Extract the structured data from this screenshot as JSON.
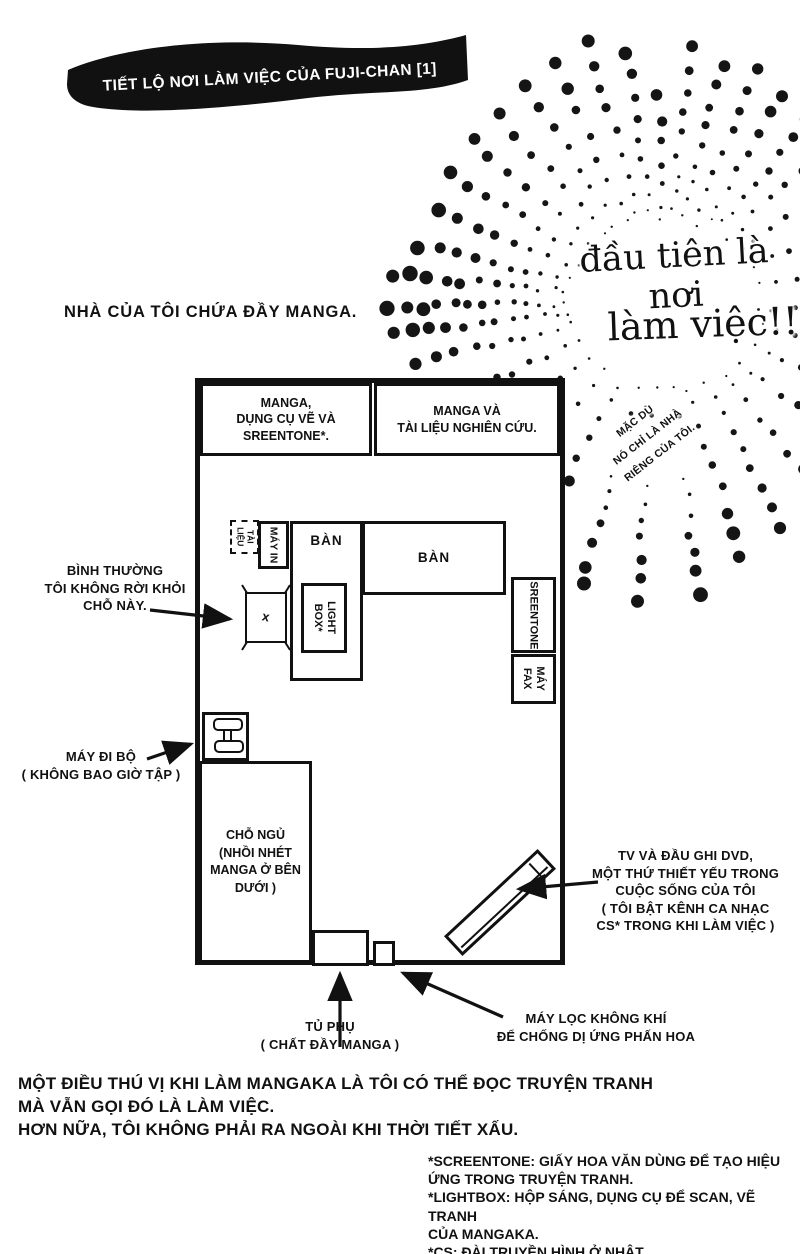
{
  "ink": "#111111",
  "paper": "#ffffff",
  "banner": {
    "title": "TIẾT LỘ NƠI LÀM VIỆC CỦA FUJI-CHAN [1]"
  },
  "intro": "NHÀ CỦA TÔI CHỨA ĐẦY MANGA.",
  "burst": {
    "line1": "đầu tiên là nơi",
    "line2": "làm việc!!",
    "aside": "MẶC DÙ\nNÓ CHỈ LÀ NHÀ\nRIÊNG CỦA TÔI.",
    "cx": 663,
    "cy": 302,
    "rays": [
      [
        -106,
        95,
        272,
        9,
        6.5
      ],
      [
        -98,
        90,
        250,
        9,
        6
      ],
      [
        -91,
        80,
        205,
        7,
        5.5
      ],
      [
        -84,
        95,
        255,
        9,
        5.5
      ],
      [
        -76,
        90,
        245,
        9,
        6
      ],
      [
        -68,
        85,
        250,
        9,
        6
      ],
      [
        -60,
        95,
        240,
        8,
        6
      ],
      [
        -52,
        100,
        230,
        8,
        5.5
      ],
      [
        -44,
        90,
        215,
        7,
        5
      ],
      [
        -34,
        95,
        195,
        6,
        5
      ],
      [
        -22,
        100,
        175,
        5,
        4.5
      ],
      [
        -10,
        100,
        155,
        4,
        4
      ],
      [
        3,
        95,
        150,
        4,
        3
      ],
      [
        14,
        100,
        175,
        5,
        4.5
      ],
      [
        26,
        100,
        195,
        6,
        5
      ],
      [
        38,
        95,
        215,
        7,
        5.5
      ],
      [
        50,
        95,
        240,
        8,
        6
      ],
      [
        62,
        90,
        255,
        9,
        6.5
      ],
      [
        73,
        90,
        268,
        9,
        7
      ],
      [
        83,
        180,
        295,
        7,
        7
      ],
      [
        83,
        85,
        115,
        2,
        2.5
      ],
      [
        95,
        185,
        300,
        7,
        7
      ],
      [
        95,
        85,
        115,
        2,
        2.5
      ],
      [
        106,
        180,
        295,
        7,
        7
      ],
      [
        106,
        88,
        115,
        2,
        2.5
      ],
      [
        118,
        95,
        228,
        7,
        6
      ],
      [
        131,
        90,
        185,
        5,
        5
      ],
      [
        143,
        92,
        200,
        6,
        5.5
      ],
      [
        155,
        95,
        225,
        8,
        6
      ],
      [
        166,
        95,
        252,
        10,
        6.5
      ],
      [
        173,
        95,
        270,
        12,
        7
      ],
      [
        179,
        100,
        273,
        13,
        7.5
      ],
      [
        -174,
        98,
        270,
        12,
        7.5
      ],
      [
        -167,
        95,
        250,
        10,
        7
      ],
      [
        -158,
        92,
        240,
        9,
        6.5
      ],
      [
        -149,
        95,
        248,
        9,
        6
      ],
      [
        -140,
        95,
        250,
        8,
        6.5
      ],
      [
        -131,
        90,
        248,
        8,
        6
      ],
      [
        -122,
        92,
        258,
        8,
        6
      ],
      [
        -114,
        90,
        262,
        8,
        6.5
      ]
    ]
  },
  "plan": {
    "shelf_left": "MANGA,\nDỤNG CỤ VẼ VÀ\nSREENTONE*.",
    "shelf_right": "MANGA VÀ\nTÀI LIỆU NGHIÊN CỨU.",
    "documents": "TÀI\nLIỆU",
    "printer": "MÁY IN",
    "desk_vertical": "BÀN",
    "desk_horizontal": "BÀN",
    "lightbox": "LIGHT\nBOX*",
    "chair_mark": "x",
    "screentone": "SREENTONE",
    "fax": "MÁY\nFAX",
    "bed": "CHỖ NGỦ\n(NHỒI NHÉT\nMANGA Ở BÊN\nDƯỚI )"
  },
  "notes": {
    "chair": "BÌNH THƯỜNG\nTÔI KHÔNG RỜI KHỎI\nCHỖ NÀY.",
    "treadmill": "MÁY ĐI BỘ\n( KHÔNG BAO GIỜ TẬP )",
    "tv": "TV VÀ ĐẦU GHI DVD,\nMỘT THỨ THIẾT YẾU TRONG\nCUỘC SỐNG CỦA TÔI\n( TÔI BẬT KÊNH CA NHẠC\nCS* TRONG KHI LÀM VIỆC )",
    "cabinet": "TỦ PHỤ\n( CHẤT ĐẦY MANGA )",
    "purifier": "MÁY LỌC KHÔNG KHÍ\nĐỂ CHỐNG DỊ ỨNG PHẤN HOA"
  },
  "paragraph": "MỘT ĐIỀU THÚ VỊ KHI LÀM MANGAKA LÀ TÔI CÓ THỂ ĐỌC TRUYỆN TRANH\nMÀ VẪN GỌI ĐÓ LÀ LÀM VIỆC.\nHƠN NỮA, TÔI KHÔNG PHẢI RA NGOÀI KHI THỜI TIẾT XẤU.",
  "footnotes": "*SCREENTONE: GIẤY HOA VĂN DÙNG ĐỂ TẠO HIỆU\nỨNG TRONG TRUYỆN TRANH.\n*LIGHTBOX: HỘP SÁNG, DỤNG CỤ ĐỂ SCAN, VẼ TRANH\nCỦA MANGAKA.\n*CS: ĐÀI TRUYỀN HÌNH Ở NHẬT."
}
